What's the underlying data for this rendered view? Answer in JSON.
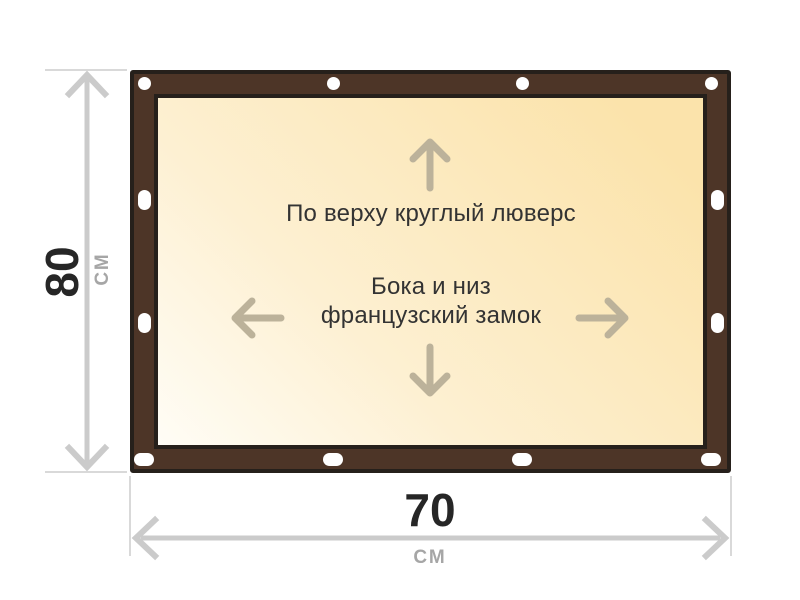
{
  "legend": {
    "top_grommet_label": "По верху круглый люверс",
    "side_bottom_label_line1": "Бока и низ",
    "side_bottom_label_line2": "французский замок"
  },
  "dimensions": {
    "height_value": "80",
    "height_unit": "см",
    "width_value": "70",
    "width_unit": "см"
  },
  "icons": {
    "top_edge": "round-grommet-icon",
    "side_edges": "vertical-slot-grommet-icon",
    "bottom_edge": "horizontal-slot-grommet-icon",
    "inside": [
      "arrow-up-icon",
      "arrow-down-icon",
      "arrow-left-icon",
      "arrow-right-icon"
    ],
    "measurements": [
      "height-dimension-arrow",
      "width-dimension-arrow"
    ]
  },
  "colors": {
    "page_background": "#ffffff",
    "frame_brown": "#4d3527",
    "frame_outline": "#26201b",
    "canvas_light": "#fffdf6",
    "canvas_gold": "#fbe3ab",
    "direction_arrow": "#bcb29a",
    "dimension_line": "#cbcbcb",
    "extension_line": "#d9d9d9",
    "label_text": "#333333",
    "dimension_number": "#262626",
    "dimension_unit": "#a6a6a6",
    "grommet": "#ffffff"
  }
}
